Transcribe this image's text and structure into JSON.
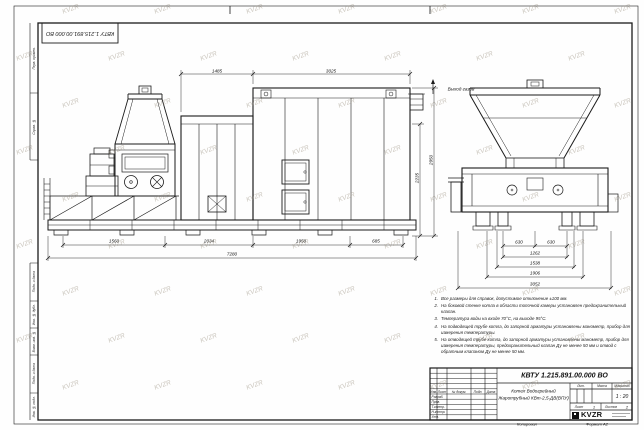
{
  "sheet": {
    "stamp_number_rotated": "КВТУ 1.215.891.00.000 ВО",
    "watermark_text": "KVZR",
    "copied_label": "Копировал",
    "format_note": "Формат А2"
  },
  "margin_labels": {
    "perv_primen": "Перв. примен.",
    "sprav_no": "Справ. №",
    "podp_data_upper": "Подп. и дата",
    "inv_dubl": "Инв. № дубл.",
    "vzam_inv": "Взам. инв. №",
    "podp_data_lower": "Подп. и дата",
    "inv_podl": "Инв. № подл."
  },
  "drawing": {
    "gas_outlet_label": "Выход газов",
    "dims_top": [
      "1485",
      "3025"
    ],
    "dims_height": [
      "2235",
      "2950"
    ],
    "dims_bottom_chain": [
      "1560",
      "2034",
      "1950",
      "685"
    ],
    "dim_bottom_total": "7280",
    "dims_front": [
      "630",
      "630",
      "1262",
      "1538",
      "1906",
      "3052"
    ]
  },
  "notes": {
    "items": [
      {
        "n": "1.",
        "text": "Все размеры для справок, допустимое отклонение ±100 мм."
      },
      {
        "n": "2.",
        "text": "На боковой стенке котла в области топочной камеры установлен предохранительный клапан."
      },
      {
        "n": "3.",
        "text": "Температура воды на входе 70°С, на выходе 95°С."
      },
      {
        "n": "4.",
        "text": "На подводящей трубе котла, до запорной арматуры установлены манометр, прибор для измерения температуры."
      },
      {
        "n": "5.",
        "text": "На отводящей трубе котла, до запорной арматуры установлены манометр, прибор для измерения температуры, предохранительный клапан Ду не менее 50 мм и отвод с обратным клапаном Ду не менее 50 мм."
      }
    ]
  },
  "title_block": {
    "doc_number": "КВТУ 1.215.891.00.000 ВО",
    "name_line1": "Котел Водогрейный",
    "name_line2": "Жаротрубный КВт-2,5-ДВ(ВПУ)",
    "header_cols": [
      "Изм.",
      "Лист",
      "№ докум.",
      "Подп.",
      "Дата"
    ],
    "row_labels": [
      "Разраб.",
      "Пров.",
      "Т.контр.",
      "Н.контр.",
      "Утв."
    ],
    "lit_label": "Лит.",
    "mass_label": "Масса",
    "scale_label": "Масштаб",
    "scale_value": "1 : 20",
    "sheet_label": "Лист",
    "sheet_value": "1",
    "sheets_label": "Листов",
    "sheets_value": "2",
    "logo_text": "KVZR"
  }
}
